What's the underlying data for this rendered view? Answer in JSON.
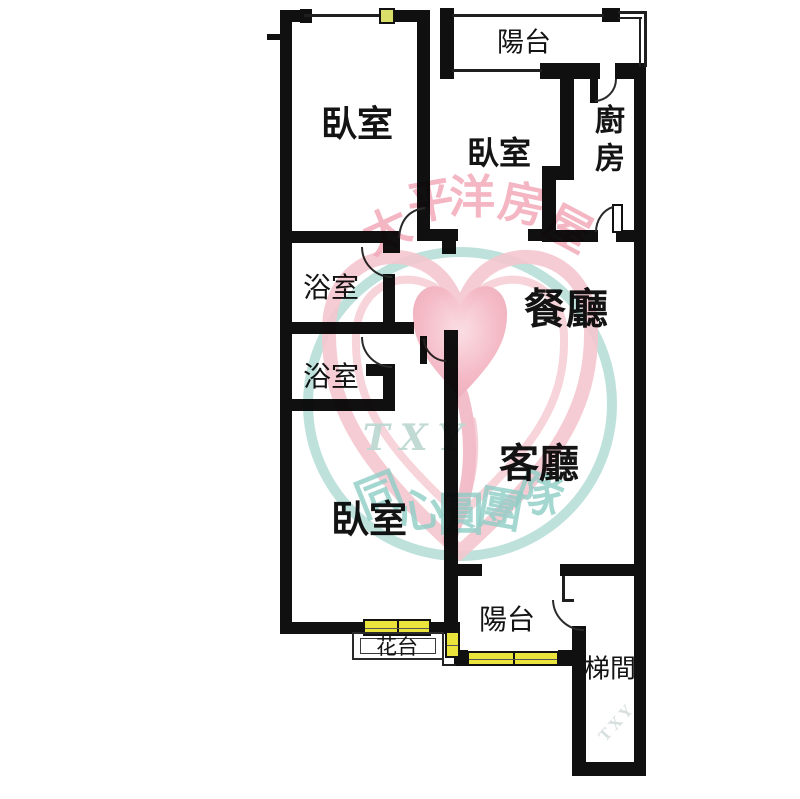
{
  "floorplan": {
    "type": "apartment-floor-plan",
    "rooms": {
      "balcony_top": {
        "label": "陽台"
      },
      "bedroom1": {
        "label": "臥室"
      },
      "bedroom2": {
        "label": "臥室"
      },
      "kitchen": {
        "label": "廚房"
      },
      "bathroom1": {
        "label": "浴室"
      },
      "bathroom2": {
        "label": "浴室"
      },
      "dining": {
        "label": "餐廳"
      },
      "living": {
        "label": "客廳"
      },
      "bedroom3": {
        "label": "臥室"
      },
      "balcony_bottom": {
        "label": "陽台"
      },
      "flower_stand": {
        "label": "花台"
      },
      "stairwell": {
        "label": "梯間"
      }
    },
    "watermark": {
      "brand": {
        "chars": [
          "太",
          "平",
          "洋",
          "房",
          "屋"
        ]
      },
      "team": {
        "abbr": "TXY",
        "chars": [
          "同",
          "心",
          "圓",
          "團",
          "隊"
        ]
      },
      "corner_text": "TXY"
    },
    "colors": {
      "wall": "#101010",
      "window_highlight": "#e9e33c",
      "window_marker": "#d9df69",
      "watermark_pink": "#f2a9b8",
      "watermark_teal": "#8fcdc5",
      "watermark_circle": "#b7ded7"
    }
  }
}
